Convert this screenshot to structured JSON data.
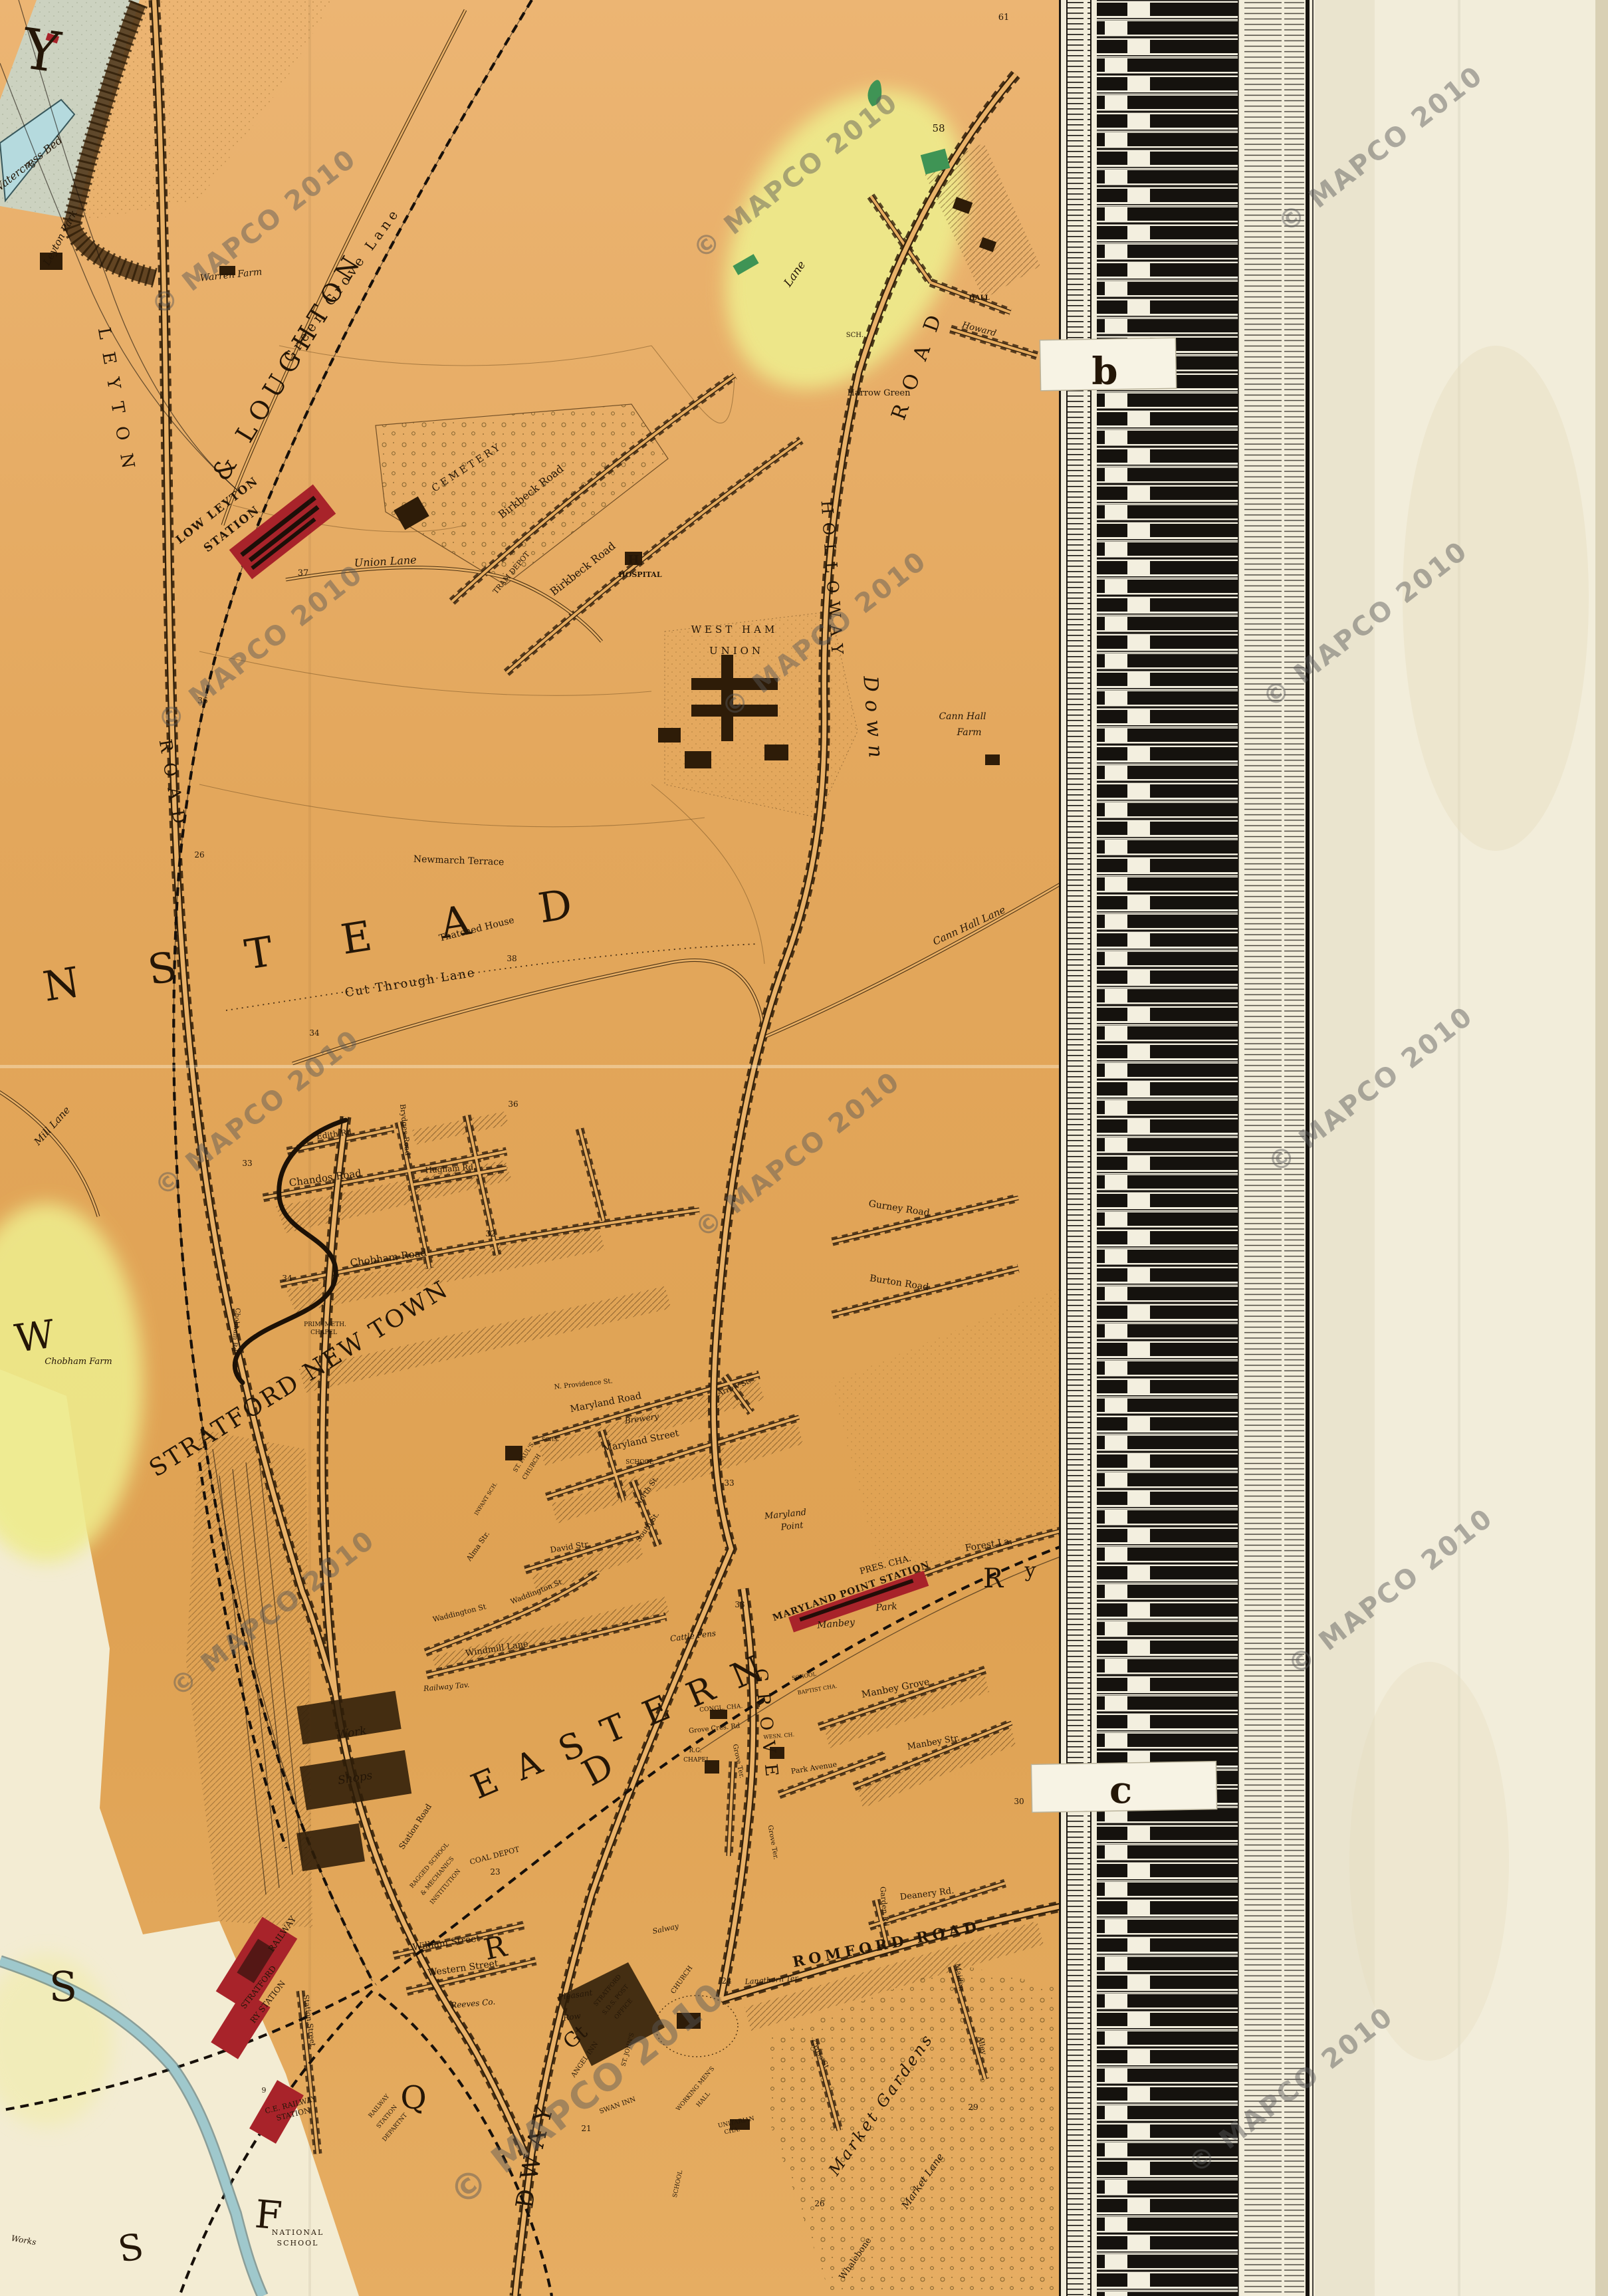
{
  "watermark": {
    "text": "© MAPCO 2010",
    "color": "#585858"
  },
  "border": {
    "tab_b": "b",
    "tab_c": "c"
  },
  "districts": {
    "wanstead": "WANSTEAD",
    "stratford_new_town": "STRATFORD NEW TOWN",
    "eastern": "EASTERN",
    "big_d": "D",
    "gt": "Gt",
    "broadway": "BROADWAY",
    "grove_big": "GROVE",
    "holloway": "HOLLOWAY",
    "down": "Down",
    "leyton_vert": "LEYTON",
    "road_vert_w": "ROAD",
    "road_vert_e": "ROAD",
    "letter_y": "Y",
    "letter_w": "W",
    "letter_s_upper": "S",
    "letter_s_lower": "S",
    "letter_f": "F",
    "letter_q": "Q",
    "letter_r_stratford": "R",
    "letter_r_forest": "R",
    "letter_y_forest": "y"
  },
  "railways": {
    "woodford_loughton": "WOODFORD & LOUGHTON"
  },
  "stations": {
    "low_leyton_1": "LOW LEYTON",
    "low_leyton_2": "STATION",
    "maryland_point": "MARYLAND POINT STATION",
    "stratford_1": "STRATFORD",
    "stratford_2": "RY STATION",
    "stratford_3": "RAILWAY",
    "ce_1": "C.E. RAILWAY",
    "ce_2": "STATION"
  },
  "roads": {
    "green_grove_lane": "Green Grove Lane",
    "lane_fragment": "Lane",
    "union_lane": "Union Lane",
    "birkbeck_1": "Birkbeck Road",
    "birkbeck_2": "Birkbeck Road",
    "cut_through_lane": "Cut Through Lane",
    "cann_hall_lane": "Cann Hall Lane",
    "mill_lane": "Mill Lane",
    "edith": "Edith Rd.",
    "chandos": "Chandos Road",
    "hugham": "Hugham Rd.",
    "gurney": "Gurney Road",
    "burton": "Burton Road",
    "chobham": "Chobham Road",
    "brydges": "Brydges Road",
    "chobham_vert": "Chobham Rd",
    "maryland_road": "Maryland Road",
    "maryland_street": "Maryland Street",
    "providence": "N. Providence St.",
    "north_st": "North St.",
    "south_st": "South St.",
    "david": "David Str.",
    "waddington_1": "Waddington St",
    "waddington_2": "Waddington St",
    "alma": "Alma Str.",
    "arrow": "Arrow St.",
    "windmill": "Windmill Lane",
    "station_road": "Station Road",
    "forest_lane": "Forest La.",
    "manbey_grove": "Manbey Grove",
    "manbey_str": "Manbey Str.",
    "park_avenue": "Park Avenue",
    "grove_cres": "Grove Cres. Rd",
    "grove_ter_1": "Grove Ter.",
    "grove_ter_2": "Grove Ter.",
    "romford": "ROMFORD ROAD",
    "deanery": "Deanery Rd.",
    "garden": "Garden Rd.",
    "maiden": "Maiden",
    "alley": "Alley",
    "cross_st": "Cross St",
    "market_lane": "Market Lane",
    "whalebone": "Whalebone",
    "william": "William Street",
    "western": "Western Street",
    "station_street": "Station Street",
    "langthorn": "Langthorn Ter."
  },
  "places": {
    "watercress": "Watercress Bed",
    "leyton_park": "Leyton Park",
    "warren_farm": "Warren Farm",
    "cemetery": "CEMETERY",
    "tram_depot": "TRAM DEPOT",
    "hospital": "HOSPITAL",
    "west_ham": "WEST HAM",
    "union": "UNION",
    "cann_hall_1": "Cann Hall",
    "cann_hall_2": "Farm",
    "newmarch": "Newmarch Terrace",
    "thatched": "Thatched House",
    "chobham_farm": "Chobham Farm",
    "harrow_green": "Harrow Green",
    "hall": "HALL",
    "howard": "Howard",
    "sch": "SCH.",
    "schs": "SCHS.",
    "school_1": "SCHOOL",
    "school_2": "SCHOOL",
    "school_3": "SCHOOL",
    "brewery": "Brewery",
    "st_pauls_1": "ST. PAUL'S",
    "st_pauls_2": "CHURCH",
    "infant": "INFANT SCH.",
    "maryland_pt_1": "Maryland",
    "maryland_pt_2": "Point",
    "pres_cha": "PRES. CHA.",
    "baptist": "BAPTIST CHA.",
    "congl": "CONGL. CHA.",
    "rc_1": "R.C.",
    "rc_2": "CHAPEL",
    "wesn": "WESN. CH.",
    "prim_1": "PRIM. METH.",
    "prim_2": "CHAPEL",
    "cattle_pens": "Cattle Pens",
    "railway_tav": "Railway Tav.",
    "work_1": "Work",
    "work_2": "Shops",
    "ragged_1": "RAGGED SCHOOL",
    "ragged_2": "& MECHANICS",
    "ragged_3": "INSTITUTION",
    "coal": "COAL DEPOT",
    "rly_1": "RAILWAY",
    "rly_2": "STATION",
    "rly_3": "DEPARTNT",
    "reeves": "Reeves Co.",
    "pleasant_1": "Pleasant",
    "pleasant_2": "Row",
    "po_1": "STRATFORD",
    "po_2": "S.D.S. POST",
    "po_3": "OFFICE",
    "angel": "ANGEL INN",
    "swan": "SWAN INN",
    "salway": "Salway",
    "st_johns_1": "ST. JOHN'S",
    "st_johns_2": "CHURCH",
    "wmh_1": "WORKING MEN'S",
    "wmh_2": "HALL",
    "unitarian_1": "UNITARIAN",
    "unitarian_2": "CHA.",
    "market_gardens": "Market Gardens",
    "manbey": "Manbey",
    "park": "Park",
    "national_1": "NATIONAL",
    "national_2": "SCHOOL",
    "works": "Works"
  },
  "numbers": {
    "n58": "58",
    "n61": "61",
    "n45": "45",
    "n37": "37",
    "n36a": "36",
    "n36b": "36",
    "n26a": "26",
    "n26b": "26",
    "n34a": "34",
    "n34b": "34",
    "n38": "38",
    "n33a": "33",
    "n33b": "33",
    "n33c": "33",
    "n32": "32",
    "n23": "23",
    "n21": "21",
    "n24": "24",
    "n29": "29",
    "n30": "30",
    "n9": "9"
  }
}
